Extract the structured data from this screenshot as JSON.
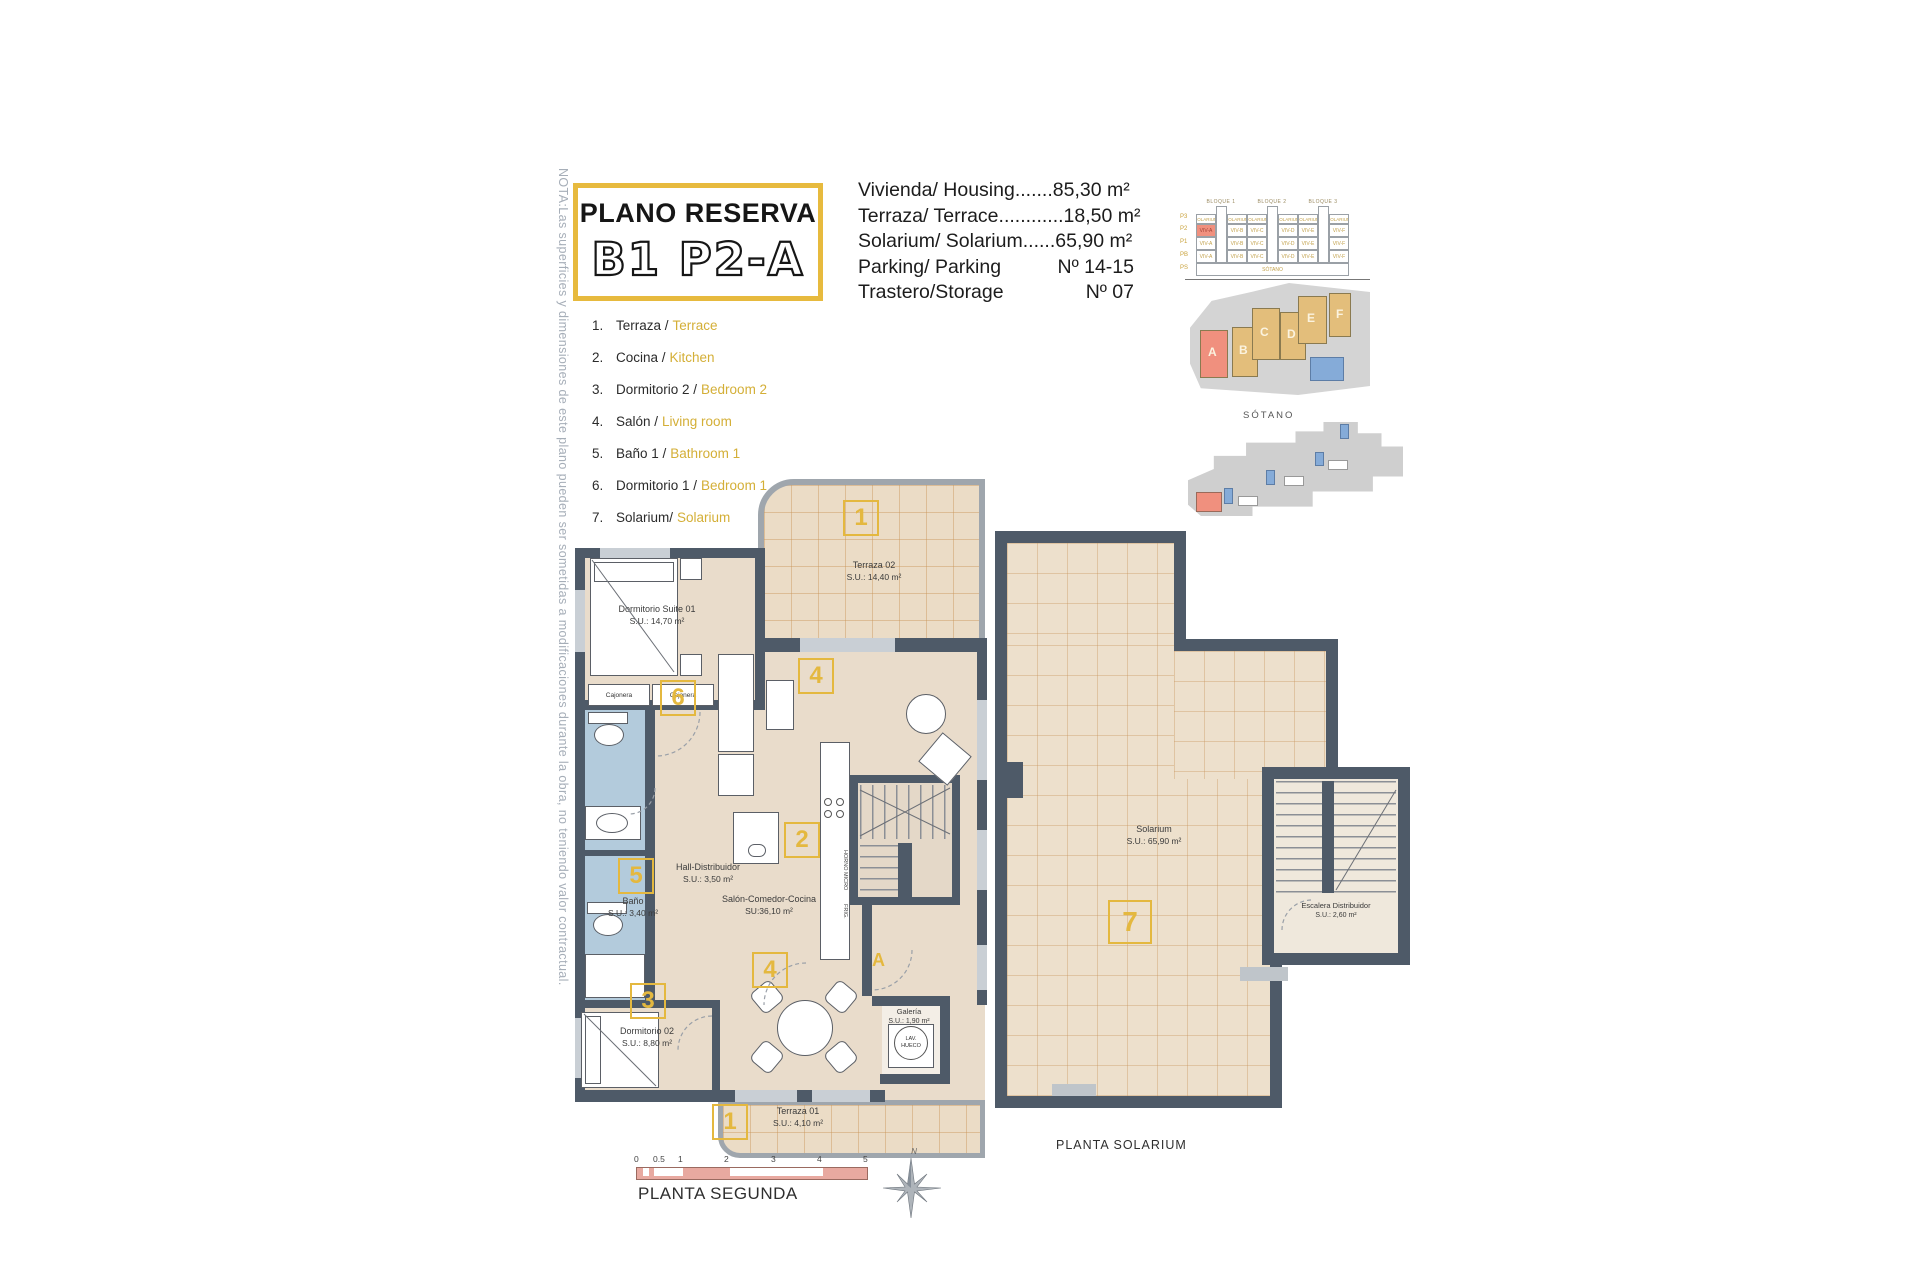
{
  "note": {
    "text": "NOTA:Las superficies y dimensiones de este plano pueden ser sometidas a modificaciones durante la obra, no teniendo valor contractual."
  },
  "title": {
    "line1": "PLANO RESERVA",
    "line2": "B1 P2-A"
  },
  "details": {
    "rows": [
      {
        "label": "Vivienda/ Housing",
        "leader": ".......",
        "value": "85,30 m²"
      },
      {
        "label": "Terraza/ Terrace",
        "leader": "............",
        "value": "18,50 m²"
      },
      {
        "label": "Solarium/ Solarium",
        "leader": "......",
        "value": "65,90 m²"
      },
      {
        "label": "Parking/ Parking",
        "leader": "",
        "value": "Nº 14-15"
      },
      {
        "label": "Trastero/Storage",
        "leader": "",
        "value": "Nº 07"
      }
    ]
  },
  "legend": {
    "items": [
      {
        "num": "1.",
        "es": "Terraza /",
        "en": "Terrace"
      },
      {
        "num": "2.",
        "es": "Cocina /",
        "en": "Kitchen"
      },
      {
        "num": "3.",
        "es": "Dormitorio 2 /",
        "en": "Bedroom 2"
      },
      {
        "num": "4.",
        "es": "Salón /",
        "en": "Living room"
      },
      {
        "num": "5.",
        "es": "Baño 1 /",
        "en": "Bathroom 1"
      },
      {
        "num": "6.",
        "es": "Dormitorio 1 /",
        "en": "Bedroom 1"
      },
      {
        "num": "7.",
        "es": "Solarium/",
        "en": "Solarium"
      }
    ]
  },
  "elevation": {
    "blocks": [
      "BLOQUE 1",
      "BLOQUE 2",
      "BLOQUE 3"
    ],
    "floors": [
      "P3",
      "P2",
      "P1",
      "PB",
      "PS"
    ],
    "solarium_label": "SOLARIUM",
    "units": [
      "VIV-A",
      "VIV-B",
      "VIV-C",
      "VIV-D",
      "VIV-E",
      "VIV-F"
    ],
    "basement_label": "SÓTANO"
  },
  "siteplan": {
    "letters": [
      "A",
      "B",
      "C",
      "D",
      "E",
      "F"
    ]
  },
  "sotano_plan": {
    "title": "SÓTANO"
  },
  "plan_second": {
    "rooms": {
      "terraza02": {
        "name": "Terraza 02",
        "area": "S.U.: 14,40 m²"
      },
      "suite": {
        "name": "Dormitorio Suite 01",
        "area": "S.U.: 14,70 m²"
      },
      "hall": {
        "name": "Hall-Distribuidor",
        "area": "S.U.: 3,50 m²"
      },
      "bano": {
        "name": "Baño",
        "area": "S.U.: 3,40 m²"
      },
      "salon": {
        "name": "Salón-Comedor-Cocina",
        "area": "SU:36,10 m²"
      },
      "dorm02": {
        "name": "Dormitorio 02",
        "area": "S.U.: 8,80 m²"
      },
      "galeria": {
        "name": "Galería",
        "area": "S.U.: 1,90 m²"
      },
      "terraza01": {
        "name": "Terraza 01",
        "area": "S.U.: 4,10 m²"
      }
    },
    "badges": {
      "terraza02": "1",
      "living": "4",
      "dorm1": "6",
      "bano": "5",
      "cocina": "2",
      "dining": "4",
      "dorm2": "3",
      "terraza01": "1",
      "entrance": "A"
    },
    "cajonera": "Cajonera",
    "horno": "HORNO MICRO",
    "frig": "FRIG.",
    "lav1": "LAV.",
    "lav2": "HUECO",
    "caption": "PLANTA SEGUNDA"
  },
  "plan_solarium": {
    "solarium": {
      "name": "Solarium",
      "area": "S.U.: 65,90 m²"
    },
    "badge": "7",
    "escalera": {
      "name": "Escalera Distribuidor",
      "area": "S.U.: 2,60 m²"
    },
    "caption": "PLANTA SOLARIUM"
  },
  "scalebar": {
    "ticks": [
      "0",
      "0.5",
      "1",
      "2",
      "3",
      "4",
      "5"
    ]
  },
  "compass": {
    "label": "N"
  }
}
